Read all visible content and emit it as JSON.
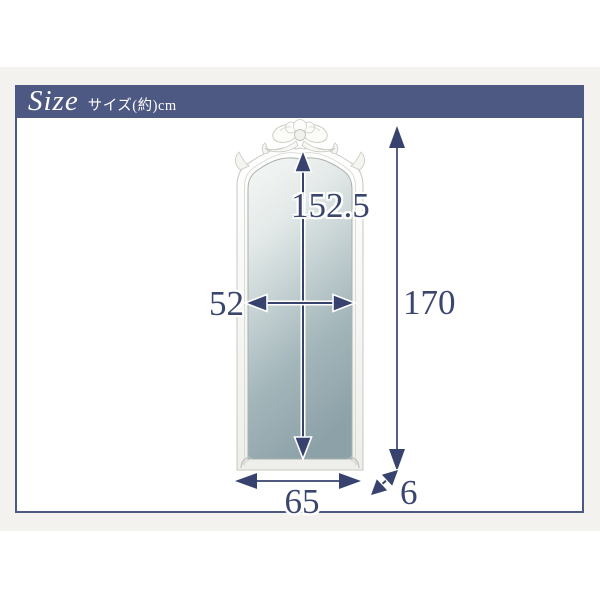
{
  "header": {
    "title": "Size",
    "subtitle": "サイズ(約)cm"
  },
  "dimensions": {
    "inner_height_cm": "152.5",
    "inner_width_cm": "52",
    "outer_height_cm": "170",
    "outer_width_cm": "65",
    "depth_cm": "6"
  },
  "illustration": {
    "name": "arched-frame-stand-mirror-with-ribbon-ornament"
  },
  "colors": {
    "accent_navy": "#4d5883",
    "arrow_navy": "#37426e",
    "dimension_text": "#3b466f",
    "background_band": "#f4f2ef",
    "glass_top": "#f1f4f3",
    "glass_bottom": "#8ca1a8"
  }
}
